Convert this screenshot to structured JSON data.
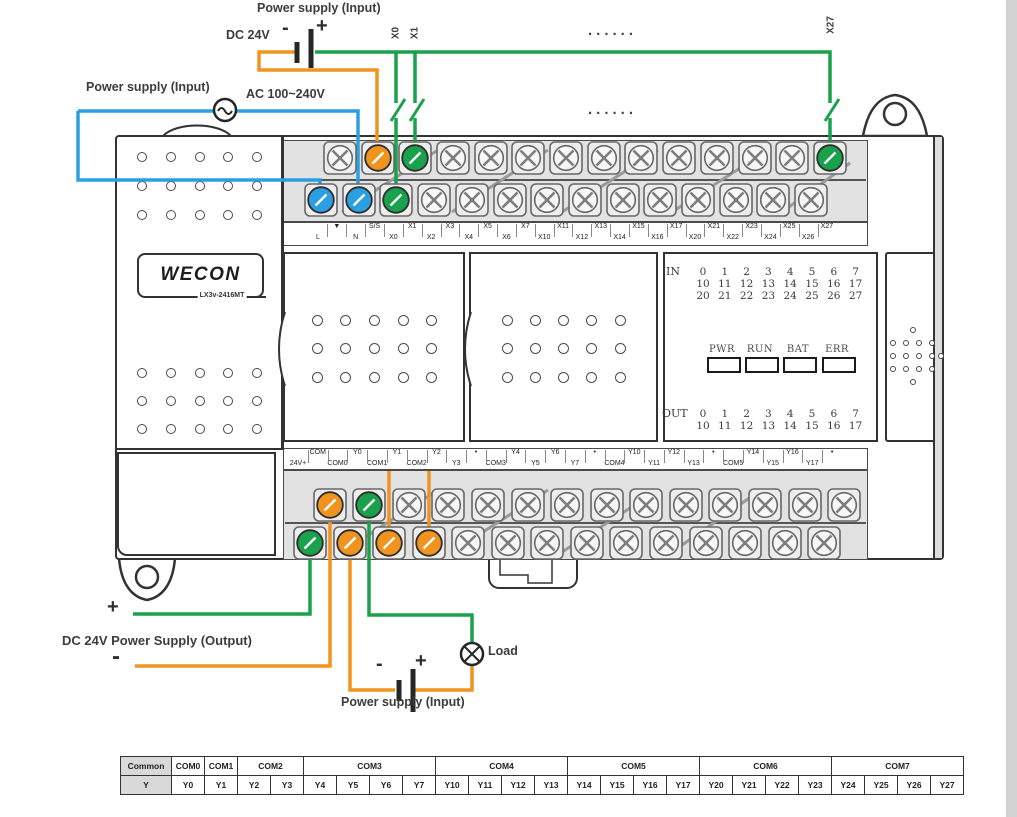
{
  "colors": {
    "green": "#1aa14b",
    "orange": "#f0941f",
    "blue": "#2b9fe0",
    "outline": "#333333"
  },
  "dc_input_top": {
    "title": "Power supply (Input)",
    "source": "DC 24V",
    "minus": "-",
    "plus": "+",
    "x0": "X0",
    "x1": "X1",
    "x27": "X27",
    "dots": "......"
  },
  "ac_input": {
    "title": "Power supply (Input)",
    "voltage": "AC 100~240V"
  },
  "device": {
    "brand": "WECON",
    "model": "LX3v-2416MT"
  },
  "indicator_panel": {
    "in_label": "IN",
    "in_rows": [
      [
        "0",
        "1",
        "2",
        "3",
        "4",
        "5",
        "6",
        "7"
      ],
      [
        "10",
        "11",
        "12",
        "13",
        "14",
        "15",
        "16",
        "17"
      ],
      [
        "20",
        "21",
        "22",
        "23",
        "24",
        "25",
        "26",
        "27"
      ]
    ],
    "leds": [
      "PWR",
      "RUN",
      "BAT",
      "ERR"
    ],
    "out_label": "OUT",
    "out_rows": [
      [
        "0",
        "1",
        "2",
        "3",
        "4",
        "5",
        "6",
        "7"
      ],
      [
        "10",
        "11",
        "12",
        "13",
        "14",
        "15",
        "16",
        "17"
      ]
    ]
  },
  "terminals_top": {
    "upper": [
      "▼",
      "S/S",
      "X1",
      "X3",
      "X5",
      "X7",
      "X11",
      "X13",
      "X15",
      "X17",
      "X21",
      "X23",
      "X25",
      "X27"
    ],
    "lower": [
      "L",
      "N",
      "X0",
      "X2",
      "X4",
      "X6",
      "X10",
      "X12",
      "X14",
      "X16",
      "X20",
      "X22",
      "X24",
      "X26"
    ],
    "colored": {
      "L": "blue",
      "N": "blue",
      "X0": "green",
      "S/S": "orange",
      "X1": "green",
      "X27": "green"
    }
  },
  "terminals_bottom": {
    "upper": [
      "COM",
      "Y0",
      "Y1",
      "Y2",
      "•",
      "Y4",
      "Y6",
      "•",
      "Y10",
      "Y12",
      "•",
      "Y14",
      "Y16",
      "•"
    ],
    "lower": [
      "24V+",
      "COM0",
      "COM1",
      "COM2",
      "Y3",
      "COM3",
      "Y5",
      "Y7",
      "COM4",
      "Y11",
      "Y13",
      "COM5",
      "Y15",
      "Y17"
    ],
    "colored": {
      "24V+": "green",
      "COM": "orange",
      "COM0": "orange",
      "COM1": "orange",
      "COM2": "orange",
      "Y0": "green"
    }
  },
  "dc_output": {
    "plus": "+",
    "label": "DC 24V Power Supply (Output)",
    "minus": "-"
  },
  "load": {
    "label": "Load"
  },
  "ps_input_bottom": {
    "minus": "-",
    "plus": "+",
    "label": "Power supply (Input)"
  },
  "mapping_table": {
    "common_row": [
      {
        "label": "Common",
        "span": 1
      },
      {
        "label": "COM0",
        "span": 1
      },
      {
        "label": "COM1",
        "span": 1
      },
      {
        "label": "COM2",
        "span": 2
      },
      {
        "label": "COM3",
        "span": 4
      },
      {
        "label": "COM4",
        "span": 4
      },
      {
        "label": "COM5",
        "span": 4
      },
      {
        "label": "COM6",
        "span": 4
      },
      {
        "label": "COM7",
        "span": 4
      }
    ],
    "y_row": [
      "Y",
      "Y0",
      "Y1",
      "Y2",
      "Y3",
      "Y4",
      "Y5",
      "Y6",
      "Y7",
      "Y10",
      "Y11",
      "Y12",
      "Y13",
      "Y14",
      "Y15",
      "Y16",
      "Y17",
      "Y20",
      "Y21",
      "Y22",
      "Y23",
      "Y24",
      "Y25",
      "Y26",
      "Y27"
    ]
  }
}
